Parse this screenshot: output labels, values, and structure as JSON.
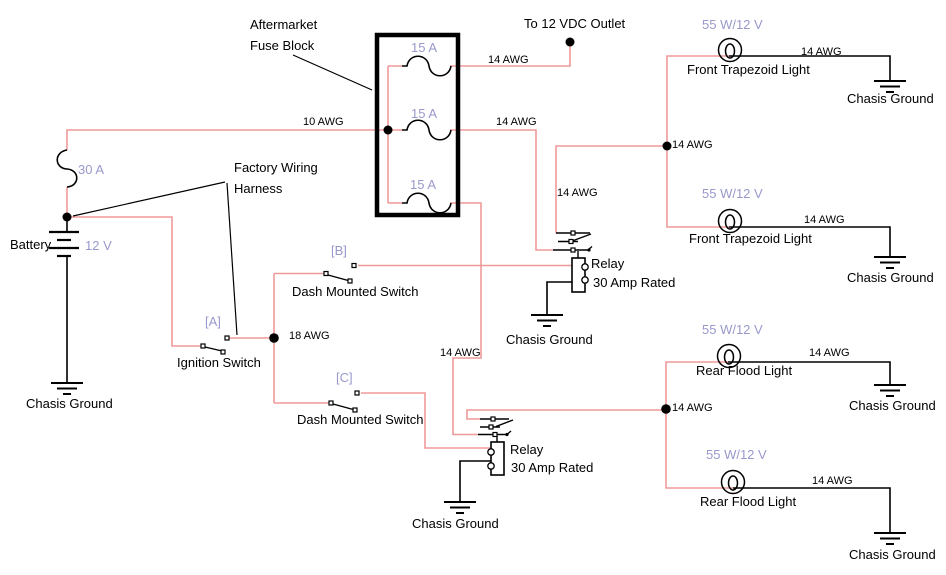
{
  "diagram_title": "12 VDC auxiliary lighting wiring diagram",
  "annotations": {
    "aftermarket_line1": "Aftermarket",
    "aftermarket_line2": "Fuse Block",
    "factory_line1": "Factory Wiring",
    "factory_line2": "Harness",
    "to_outlet": "To 12 VDC Outlet"
  },
  "labels": {
    "awg14": "14 AWG",
    "awg10": "10 AWG",
    "awg18": "18 AWG",
    "fuse15": "15 A",
    "fuse30": "30 A",
    "battery": "Battery",
    "battery_voltage": "12 V",
    "lamp_rating": "55 W/12 V",
    "front_light": "Front Trapezoid Light",
    "rear_light": "Rear Flood Light",
    "chassis_ground": "Chasis Ground",
    "relay": "Relay",
    "relay_rating": "30 Amp Rated",
    "ignition": "Ignition Switch",
    "dash_switch": "Dash Mounted Switch",
    "tag_a": "[A]",
    "tag_b": "[B]",
    "tag_c": "[C]"
  },
  "colors": {
    "power_wire": "#F09999",
    "ground_wire": "#000000",
    "rating_text": "#9999CC",
    "label_text": "#000000",
    "background": "#FFFFFF"
  }
}
